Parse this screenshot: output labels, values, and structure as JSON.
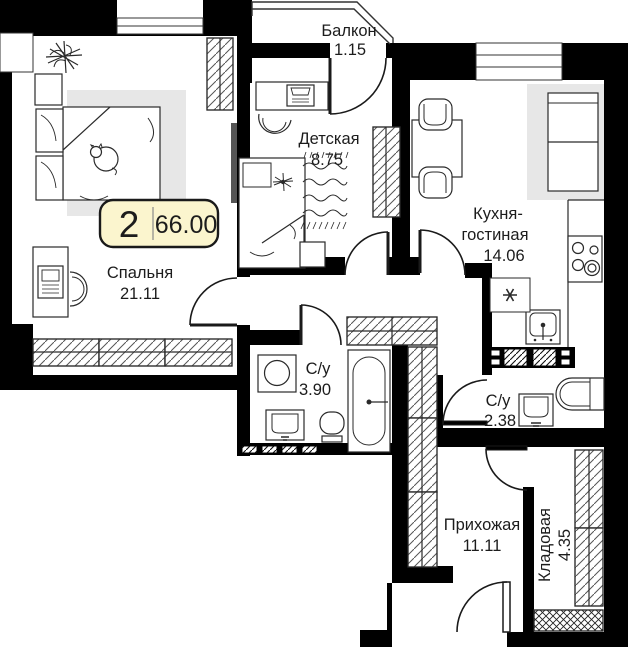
{
  "plan": {
    "badge": {
      "rooms_count": "2",
      "total_area": "66.00"
    },
    "rooms": {
      "bedroom": {
        "name": "Спальня",
        "area": "21.11"
      },
      "kids": {
        "name": "Детская",
        "area": "8.75"
      },
      "balcony": {
        "name": "Балкон",
        "area": "1.15"
      },
      "kitchen": {
        "name_line1": "Кухня-",
        "name_line2": "гостиная",
        "area": "14.06"
      },
      "bath_big": {
        "name": "С/у",
        "area": "3.90"
      },
      "bath_small": {
        "name": "С/у",
        "area": "2.38"
      },
      "hallway": {
        "name": "Прихожая",
        "area": "11.11"
      },
      "storage": {
        "name": "Кладовая",
        "area": "4.35"
      }
    },
    "symbols": {
      "fridge_niche": "asterisk-marker",
      "wardrobe_fill": "diagonal-hatch",
      "shaft_fill": "diagonal-hatch-dense"
    },
    "colors": {
      "wall": "#000000",
      "badge_fill": "#FBF5CE",
      "badge_border": "#1a1a1a",
      "furniture_gray": "#E7E7E7",
      "line": "#2a2a2a"
    }
  }
}
